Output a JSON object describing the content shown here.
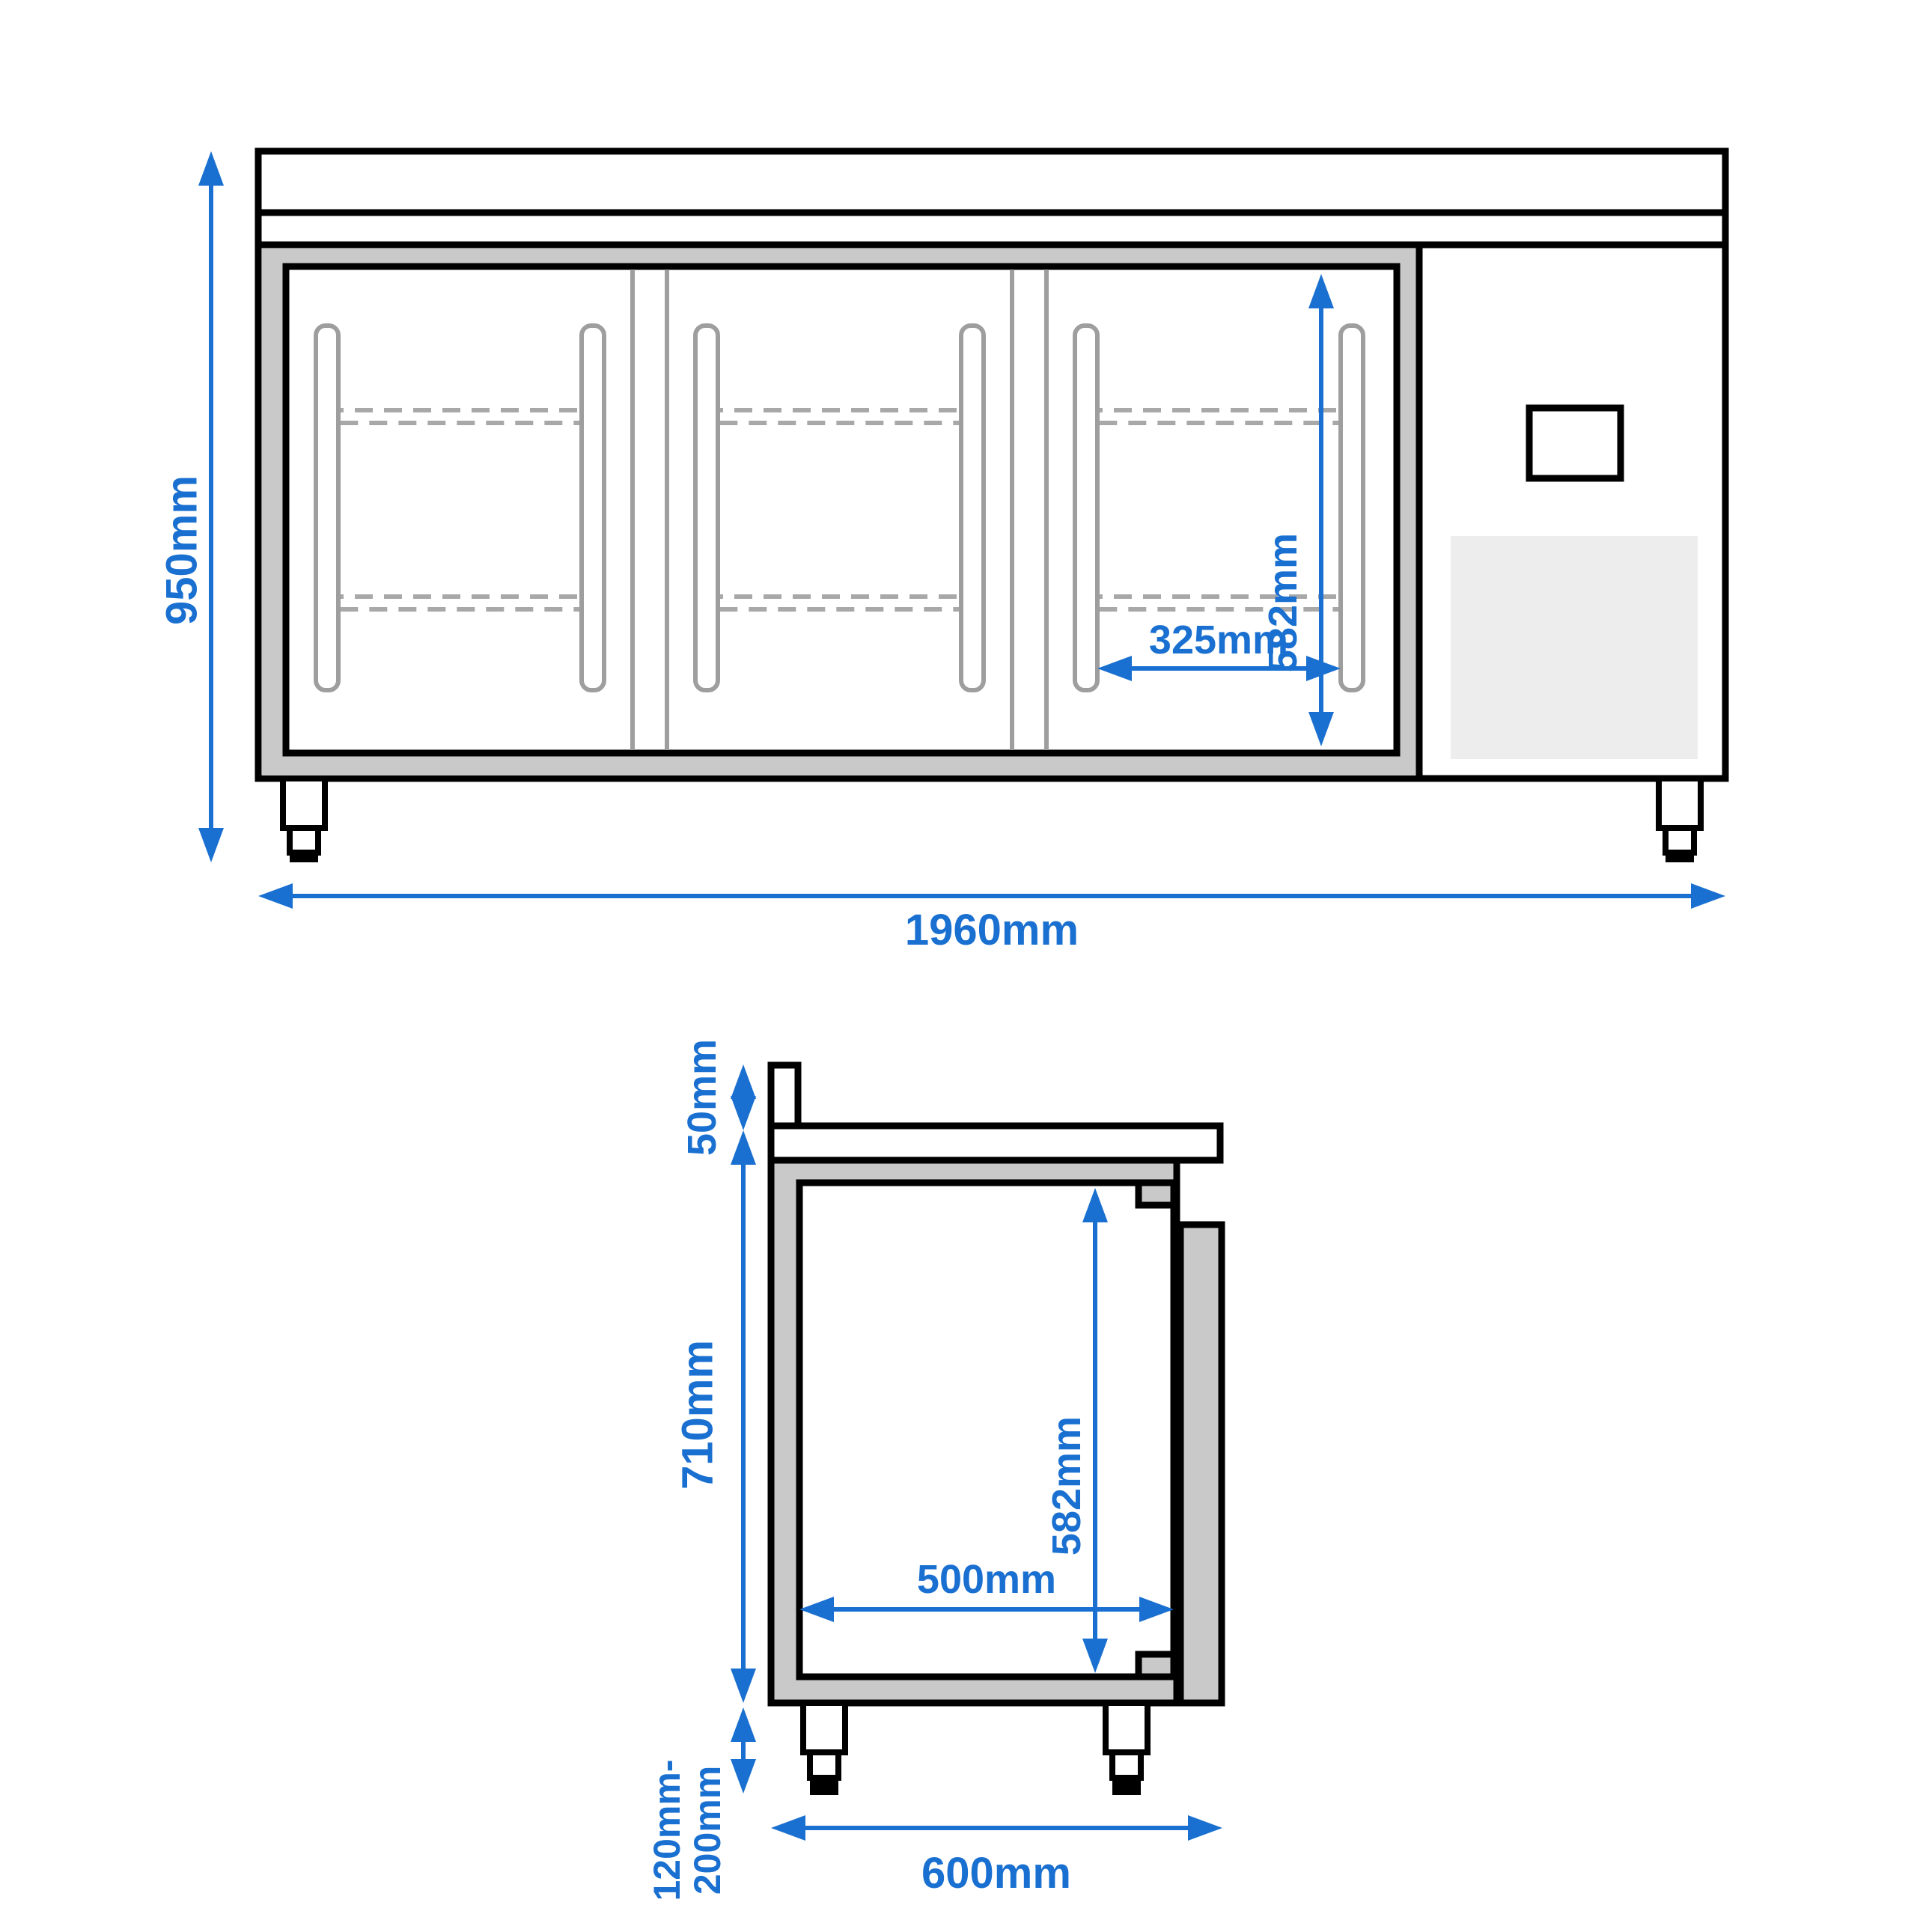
{
  "front_view": {
    "title": "front-view",
    "dimensions": {
      "overall_height": "950mm",
      "overall_width": "1960mm",
      "door_opening_height": "582mm",
      "door_opening_width": "325mm"
    },
    "doors_count": 3,
    "shelves_per_door": 2
  },
  "side_view": {
    "title": "side-view",
    "dimensions": {
      "countertop_upstand": "50mm",
      "body_height": "710mm",
      "feet_height_min": "120mm-",
      "feet_height_max": "200mm",
      "overall_depth": "600mm",
      "interior_height": "582mm",
      "interior_depth": "500mm"
    }
  },
  "colors": {
    "dimension_blue": "#1a70d0",
    "outline_black": "#000000",
    "frame_gray": "#c9c9c9",
    "detail_gray": "#9e9e9e",
    "shelf_dash_gray": "#a8a8a8",
    "grille_gray": "#ededed",
    "background": "#ffffff"
  }
}
